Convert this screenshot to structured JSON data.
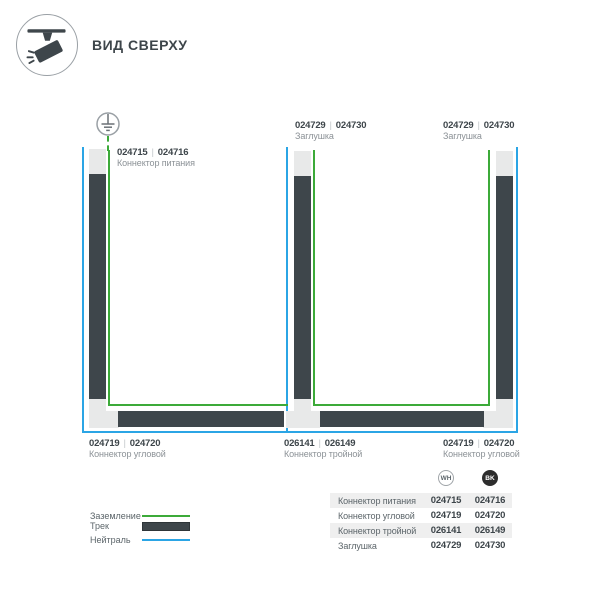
{
  "header": {
    "title": "ВИД СВЕРХУ"
  },
  "diagram": {
    "separator": "|",
    "parts": {
      "power": {
        "wh": "024715",
        "bk": "024716",
        "name": "Коннектор питания"
      },
      "endcap_mid": {
        "wh": "024729",
        "bk": "024730",
        "name": "Заглушка"
      },
      "endcap_right": {
        "wh": "024729",
        "bk": "024730",
        "name": "Заглушка"
      },
      "corner_left": {
        "wh": "024719",
        "bk": "024720",
        "name": "Коннектор угловой"
      },
      "tee": {
        "wh": "026141",
        "bk": "026149",
        "name": "Коннектор тройной"
      },
      "corner_right": {
        "wh": "024719",
        "bk": "024720",
        "name": "Коннектор угловой"
      }
    }
  },
  "legend": {
    "ground": "Заземление",
    "track": "Трек",
    "neutral": "Нейтраль"
  },
  "table": {
    "col_wh": "WH",
    "col_bk": "BK",
    "rows": [
      {
        "label": "Коннектор питания",
        "wh": "024715",
        "bk": "024716"
      },
      {
        "label": "Коннектор угловой",
        "wh": "024719",
        "bk": "024720"
      },
      {
        "label": "Коннектор тройной",
        "wh": "026141",
        "bk": "026149"
      },
      {
        "label": "Заглушка",
        "wh": "024729",
        "bk": "024730"
      }
    ]
  },
  "colors": {
    "ground_green": "#3caa39",
    "neutral_blue": "#2ba5e5",
    "track_dark": "#3e464b"
  }
}
